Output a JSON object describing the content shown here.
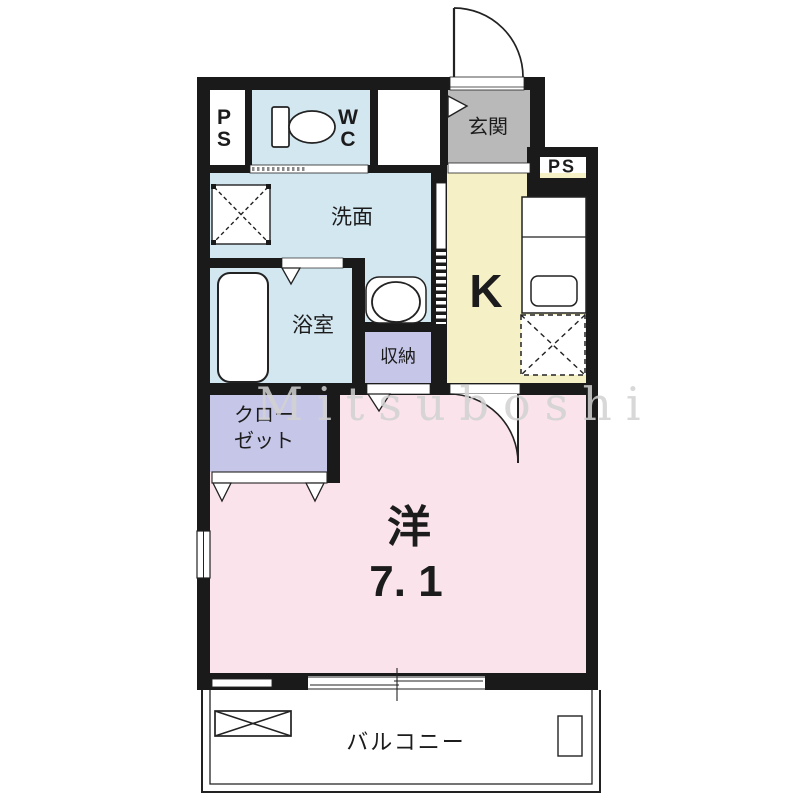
{
  "watermark": {
    "text": "Mitsuboshi"
  },
  "rooms": {
    "ps_top": {
      "label": "P\nS"
    },
    "wc": {
      "label": "W\nC"
    },
    "genkan": {
      "label": "玄関"
    },
    "ps_right": {
      "label": "PS"
    },
    "senmen": {
      "label": "洗面"
    },
    "bathroom": {
      "label": "浴室"
    },
    "storage": {
      "label": "収納"
    },
    "kitchen": {
      "label": "K"
    },
    "closet": {
      "label": "クロー\nゼット"
    },
    "main": {
      "type_label": "洋",
      "size_label": "7. 1"
    },
    "balcony": {
      "label": "バルコニー"
    }
  },
  "colors": {
    "water_rooms": "#d3e7f1",
    "kitchen": "#f6f0c6",
    "entrance": "#b9b9b9",
    "storage": "#c6c6e8",
    "main_room": "#fae3eb",
    "wall": "#1a1a1a",
    "line": "#222222"
  }
}
